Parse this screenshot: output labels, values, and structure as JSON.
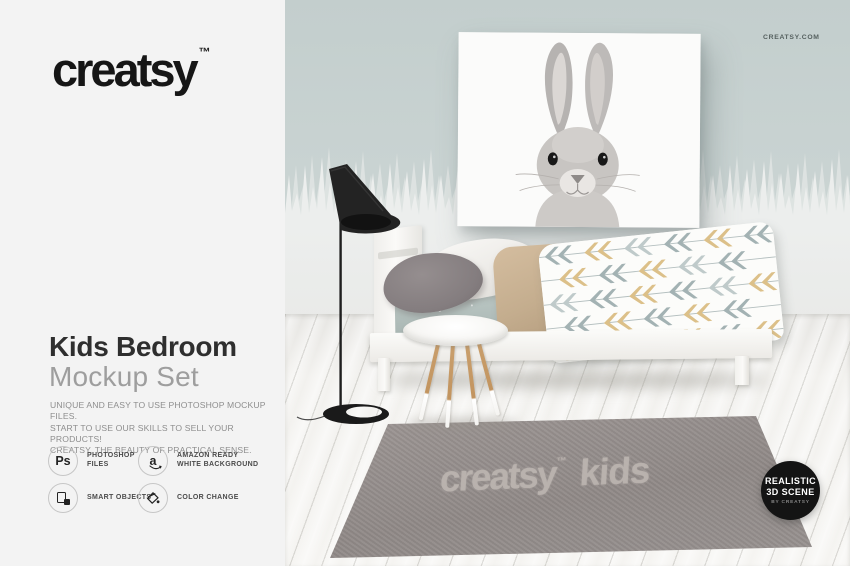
{
  "brand": {
    "logo": "creatsy",
    "trademark": "™",
    "website": "CREATSY.COM"
  },
  "panel": {
    "title_line1": "Kids Bedroom",
    "title_line2": "Mockup Set",
    "description_lines": {
      "0": "UNIQUE AND EASY TO USE PHOTOSHOP MOCKUP FILES.",
      "1": "START TO USE OUR SKILLS TO SELL YOUR PRODUCTS!",
      "2": "CREATSY. THE BEAUTY OF PRACTICAL SENSE."
    },
    "features": {
      "0": {
        "icon": "photoshop-icon",
        "glyph": "Ps",
        "line1": "PHOTOSHOP",
        "line2": "FILES"
      },
      "1": {
        "icon": "amazon-icon",
        "glyph": "a",
        "line1": "AMAZON READY",
        "line2": "WHITE BACKGROUND"
      },
      "2": {
        "icon": "smart-objects-icon",
        "line1": "SMART OBJECTS",
        "line2": ""
      },
      "3": {
        "icon": "color-change-icon",
        "line1": "COLOR CHANGE",
        "line2": ""
      }
    }
  },
  "scene": {
    "poster_subject": "rabbit portrait",
    "pillow_text": "creatsy",
    "rug_text_word1": "creatsy",
    "rug_text_tm": "™",
    "rug_text_word2": "kids",
    "badge_line1": "REALISTIC",
    "badge_line2": "3D SCENE",
    "badge_line3": "BY CREATSY"
  },
  "colors": {
    "panel_bg": "#f3f3f3",
    "logo_ink": "#161616",
    "wall_upper": "#c6d0cf",
    "wall_lower": "#eceeed",
    "floor": "#f2f1ee",
    "rug": "#948d8a",
    "badge_bg": "#141414",
    "sheet": "#b6c2bf",
    "pillow_tan": "#c8b193",
    "duvet_arrow_blue": "#a3b2b3",
    "duvet_arrow_mustard": "#dcc089"
  }
}
